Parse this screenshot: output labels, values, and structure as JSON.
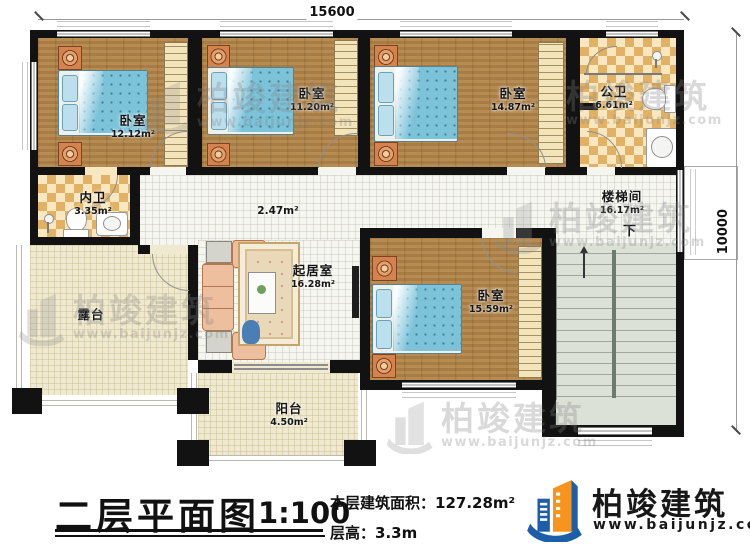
{
  "dimensions": {
    "top": "15600",
    "right": "10000"
  },
  "rooms": {
    "bedroom1": {
      "name": "卧室",
      "area": "12.12m²"
    },
    "bedroom2": {
      "name": "卧室",
      "area": "11.20m²"
    },
    "bedroom3": {
      "name": "卧室",
      "area": "14.87m²"
    },
    "bedroom4": {
      "name": "卧室",
      "area": "15.59m²"
    },
    "public_bath": {
      "name": "公卫",
      "area": "6.61m²"
    },
    "private_bath": {
      "name": "内卫",
      "area": "3.35m²"
    },
    "hallway": {
      "area": "2.47m²"
    },
    "stairwell": {
      "name": "楼梯间",
      "area": "16.17m²"
    },
    "living": {
      "name": "起居室",
      "area": "16.28m²"
    },
    "terrace": {
      "name": "露台"
    },
    "balcony": {
      "name": "阳台",
      "area": "4.50m²"
    }
  },
  "stairs": {
    "down_label": "下"
  },
  "title_block": {
    "title": "二层平面图",
    "scale": "1:100",
    "area_label": "本层建筑面积：",
    "area_value": "127.28m²",
    "floor_height_label": "层高：",
    "floor_height_value": "3.3m"
  },
  "brand": {
    "name": "柏竣建筑",
    "website": "www.baijunjz.com"
  },
  "watermark": {
    "name": "柏竣建筑",
    "website": "www.baijunjz.com"
  },
  "colors": {
    "wall": "#121212",
    "wood_floor": "#b08449",
    "tile_dark": "#e2b264",
    "tile_light": "#f8e7c0",
    "bed": "#7cc3da",
    "brand_blue": "#1c5fa8",
    "brand_orange": "#f7941d"
  }
}
